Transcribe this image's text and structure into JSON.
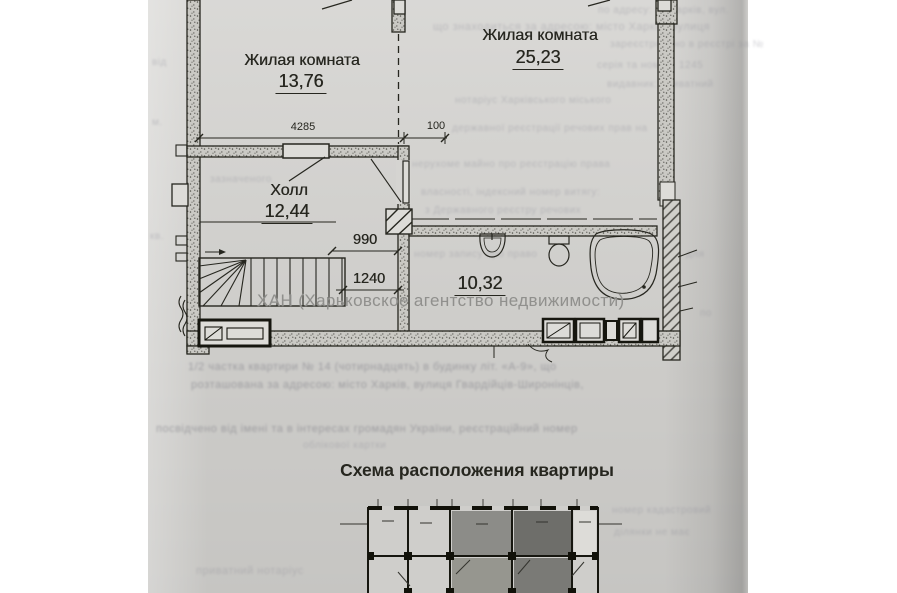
{
  "page": {
    "watermark": "ХАН (Харьковское агентство недвижимости)",
    "scheme_title": "Схема расположения квартиры"
  },
  "floor_plan": {
    "rooms": [
      {
        "name": "Жилая комната",
        "area": "13,76"
      },
      {
        "name": "Жилая комната",
        "area": "25,23"
      },
      {
        "name": "Холл",
        "area": "12,44"
      },
      {
        "area": "10,32"
      }
    ],
    "dimensions_mm": [
      "4285",
      "100",
      "990",
      "1240"
    ]
  },
  "colors": {
    "paper": "#d5d4d1",
    "ink": "#26261f",
    "watermark_gray": "#8d8d8a",
    "scheme_highlight_dark": "#6e6e6a",
    "scheme_highlight_mid": "#8c8c88"
  },
  "bleed": {
    "lines": [
      "по адресу: м. Харків, вул.",
      "що знаходиться за адресою: місто Харків, вулиця",
      "зареєстровано в реєстрі за №",
      "від",
      "серія та номер: 1245",
      "видавник: приватний",
      "нотаріус Харківського міського",
      "м.",
      "державної реєстрації речових прав на",
      "нерухоме майно про реєстрацію права",
      "власності, індексний номер витягу:",
      "з Державного реєстру речових",
      "кв.",
      "номер запису про право",
      "зазначеного",
      "1/2 частка квартири № 14 (чотирнадцять) в будинку літ. «А-9», що",
      "розташована за адресою: місто Харків, вулиця Гвардійців-Широнінців,",
      "посвідчено від імені та в інтересах громадян України, реєстраційний номер",
      "облікової картки",
      "номер кадастровий",
      "ділянки не має",
      "приватний нотаріус",
      "для",
      "по"
    ]
  }
}
